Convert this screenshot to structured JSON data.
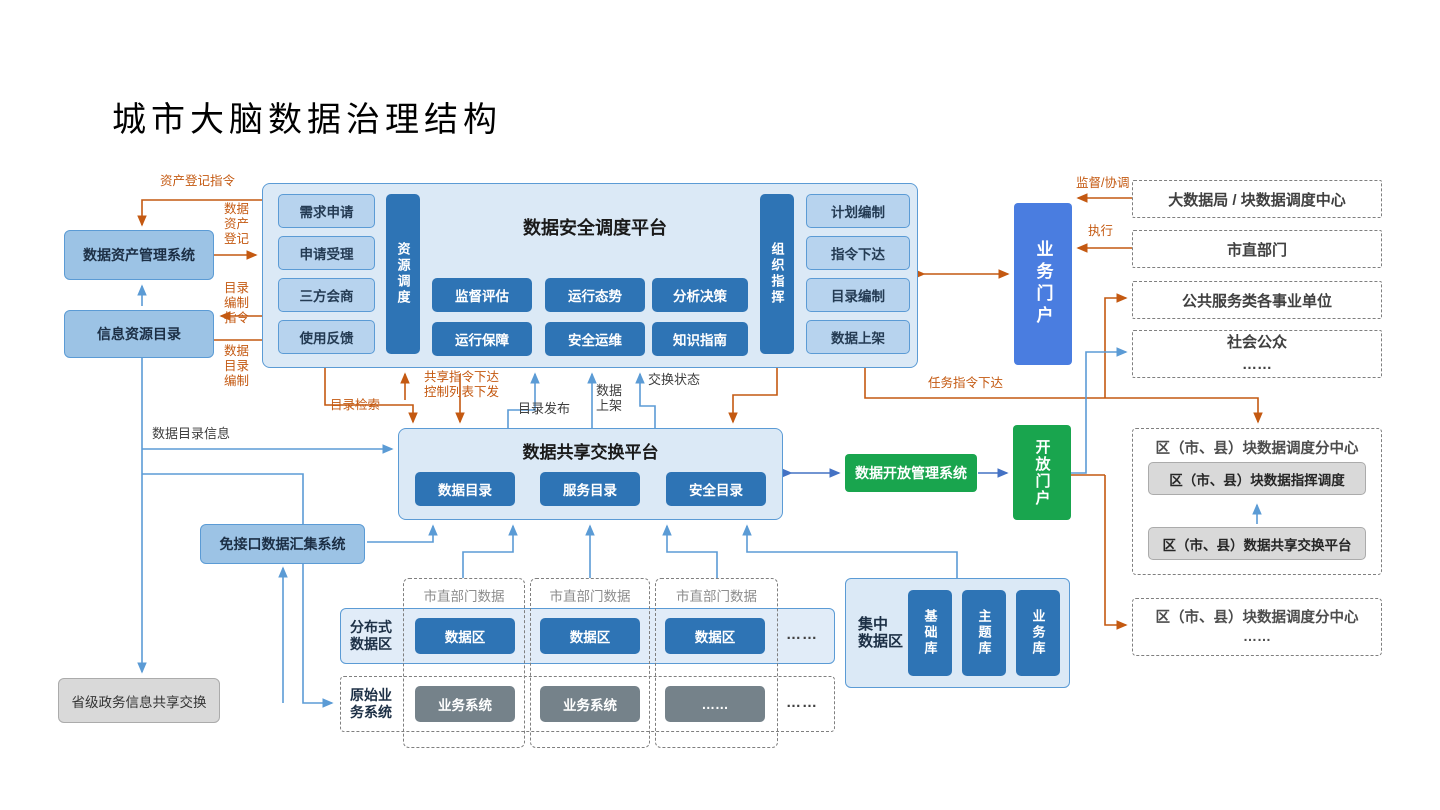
{
  "title": "城市大脑数据治理结构",
  "colors": {
    "accent_orange": "#c45911",
    "arrow_blue_light": "#5b9bd5",
    "arrow_blue_mid": "#4472c4",
    "panel_blue": "#dbe9f6",
    "item_blue": "#b7d3ee",
    "deep_blue": "#2e74b5",
    "portal_blue": "#4a7de0",
    "green": "#19a54e",
    "gray": "#d9d9d9"
  },
  "left": {
    "asset_mgmt": "数据资产管理系统",
    "info_catalog": "信息资源目录",
    "no_interface": "免接口数据汇集系统",
    "provincial": "省级政务信息共享交换"
  },
  "security_platform": {
    "title": "数据安全调度平台",
    "left_items": [
      "需求申请",
      "申请受理",
      "三方会商",
      "使用反馈"
    ],
    "left_bar": "资源调度",
    "grid": [
      "监督评估",
      "运行态势",
      "分析决策",
      "运行保障",
      "安全运维",
      "知识指南"
    ],
    "right_bar": "组织指挥",
    "right_items": [
      "计划编制",
      "指令下达",
      "目录编制",
      "数据上架"
    ]
  },
  "business_portal": "业务门户",
  "right_orgs": {
    "org1": "大数据局 / 块数据调度中心",
    "org2": "市直部门",
    "org3": "公共服务类各事业单位",
    "org4": "社会公众\n……"
  },
  "share_platform": {
    "title": "数据共享交换平台",
    "items": [
      "数据目录",
      "服务目录",
      "安全目录"
    ]
  },
  "open_mgmt": "数据开放管理系统",
  "open_portal": "开放门户",
  "district1": {
    "title": "区（市、县）块数据调度分中心",
    "items": [
      "区（市、县）块数据指挥调度",
      "区（市、县）数据共享交换平台"
    ]
  },
  "district2": {
    "title": "区（市、县）块数据调度分中心",
    "ellipsis": "……"
  },
  "bottom": {
    "distributed_label": "分布式\n数据区",
    "original_label": "原始业\n务系统",
    "dept_data_label": "市直部门数据",
    "data_zone": "数据区",
    "biz_system": "业务系统",
    "biz_ellipsis": "……",
    "ellipsis": "……",
    "central": {
      "label": "集中\n数据区",
      "items": [
        "基础库",
        "主题库",
        "业务库"
      ]
    }
  },
  "labels": {
    "asset_reg_cmd": "资产登记指令",
    "data_asset_reg": "数据\n资产\n登记",
    "catalog_make_cmd": "目录\n编制\n指令",
    "data_catalog_make": "数据\n目录\n编制",
    "supervise": "监督/协调",
    "execute": "执行",
    "share_cmd": "共享指令下达\n控制列表下发",
    "catalog_search": "目录检索",
    "catalog_publish": "目录发布",
    "data_shelf": "数据\n上架",
    "exchange_status": "交换状态",
    "task_cmd": "任务指令下达",
    "catalog_info": "数据目录信息"
  }
}
